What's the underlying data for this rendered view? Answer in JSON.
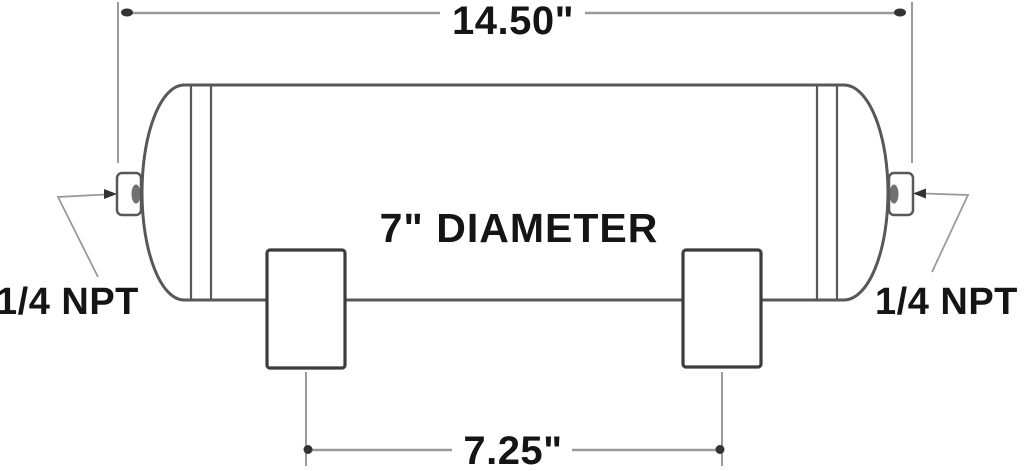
{
  "diagram": {
    "type": "technical-drawing",
    "subject": "Cylindrical air tank, side elevation with mounting brackets and end port fittings",
    "labels": {
      "overall_length": "14.50\"",
      "diameter": "7\" DIAMETER",
      "bracket_spacing": "7.25\"",
      "port_left": "1/4 NPT",
      "port_right": "1/4 NPT"
    },
    "values": {
      "overall_length_in": 14.5,
      "diameter_in": 7,
      "bracket_spacing_in": 7.25,
      "port_thread": "1/4 NPT"
    },
    "colors": {
      "background": "#ffffff",
      "outline": "#585858",
      "bracket": "#3c3c3c",
      "dimension": "#9a9a9a",
      "terminator": "#333333",
      "text": "#151515"
    }
  }
}
